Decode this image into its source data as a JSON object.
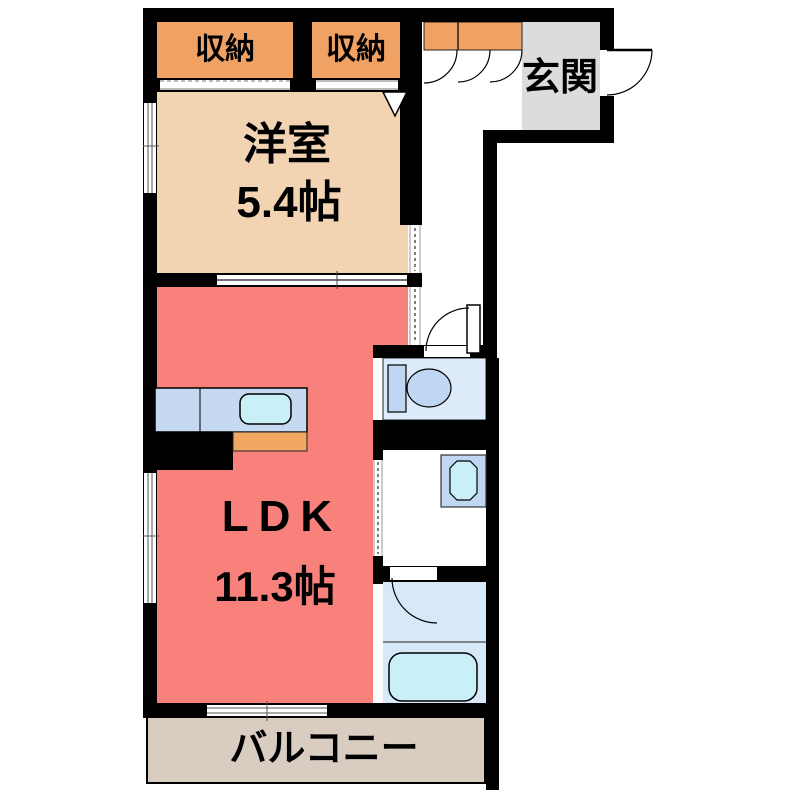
{
  "document": {
    "type": "Japanese apartment floor plan"
  },
  "rooms": {
    "closet_left": {
      "label": "収納"
    },
    "closet_right": {
      "label": "収納"
    },
    "entrance": {
      "label": "玄関"
    },
    "western_room": {
      "name": "洋室",
      "size": "5.4帖"
    },
    "ldk": {
      "name": "LDK",
      "size": "11.3帖"
    },
    "balcony": {
      "label": "バルコニー"
    }
  },
  "fixtures": [
    "shoe-cabinet",
    "kitchen-counter",
    "kitchen-sink",
    "stove",
    "toilet",
    "washbasin",
    "bathtub"
  ],
  "colors": {
    "wall": "#000000",
    "closet": "#F0A264",
    "western": "#F2D4B3",
    "ldk": "#F8817C",
    "genkan": "#DCDCDC",
    "balcony": "#D9CDC2",
    "wet": "#DCEAF9",
    "bath": "#D7E8F8",
    "fixture": "#BFD7F2",
    "sink": "#C9EFF8",
    "counter": "#C5D9F0",
    "stove": "#F0A863"
  }
}
